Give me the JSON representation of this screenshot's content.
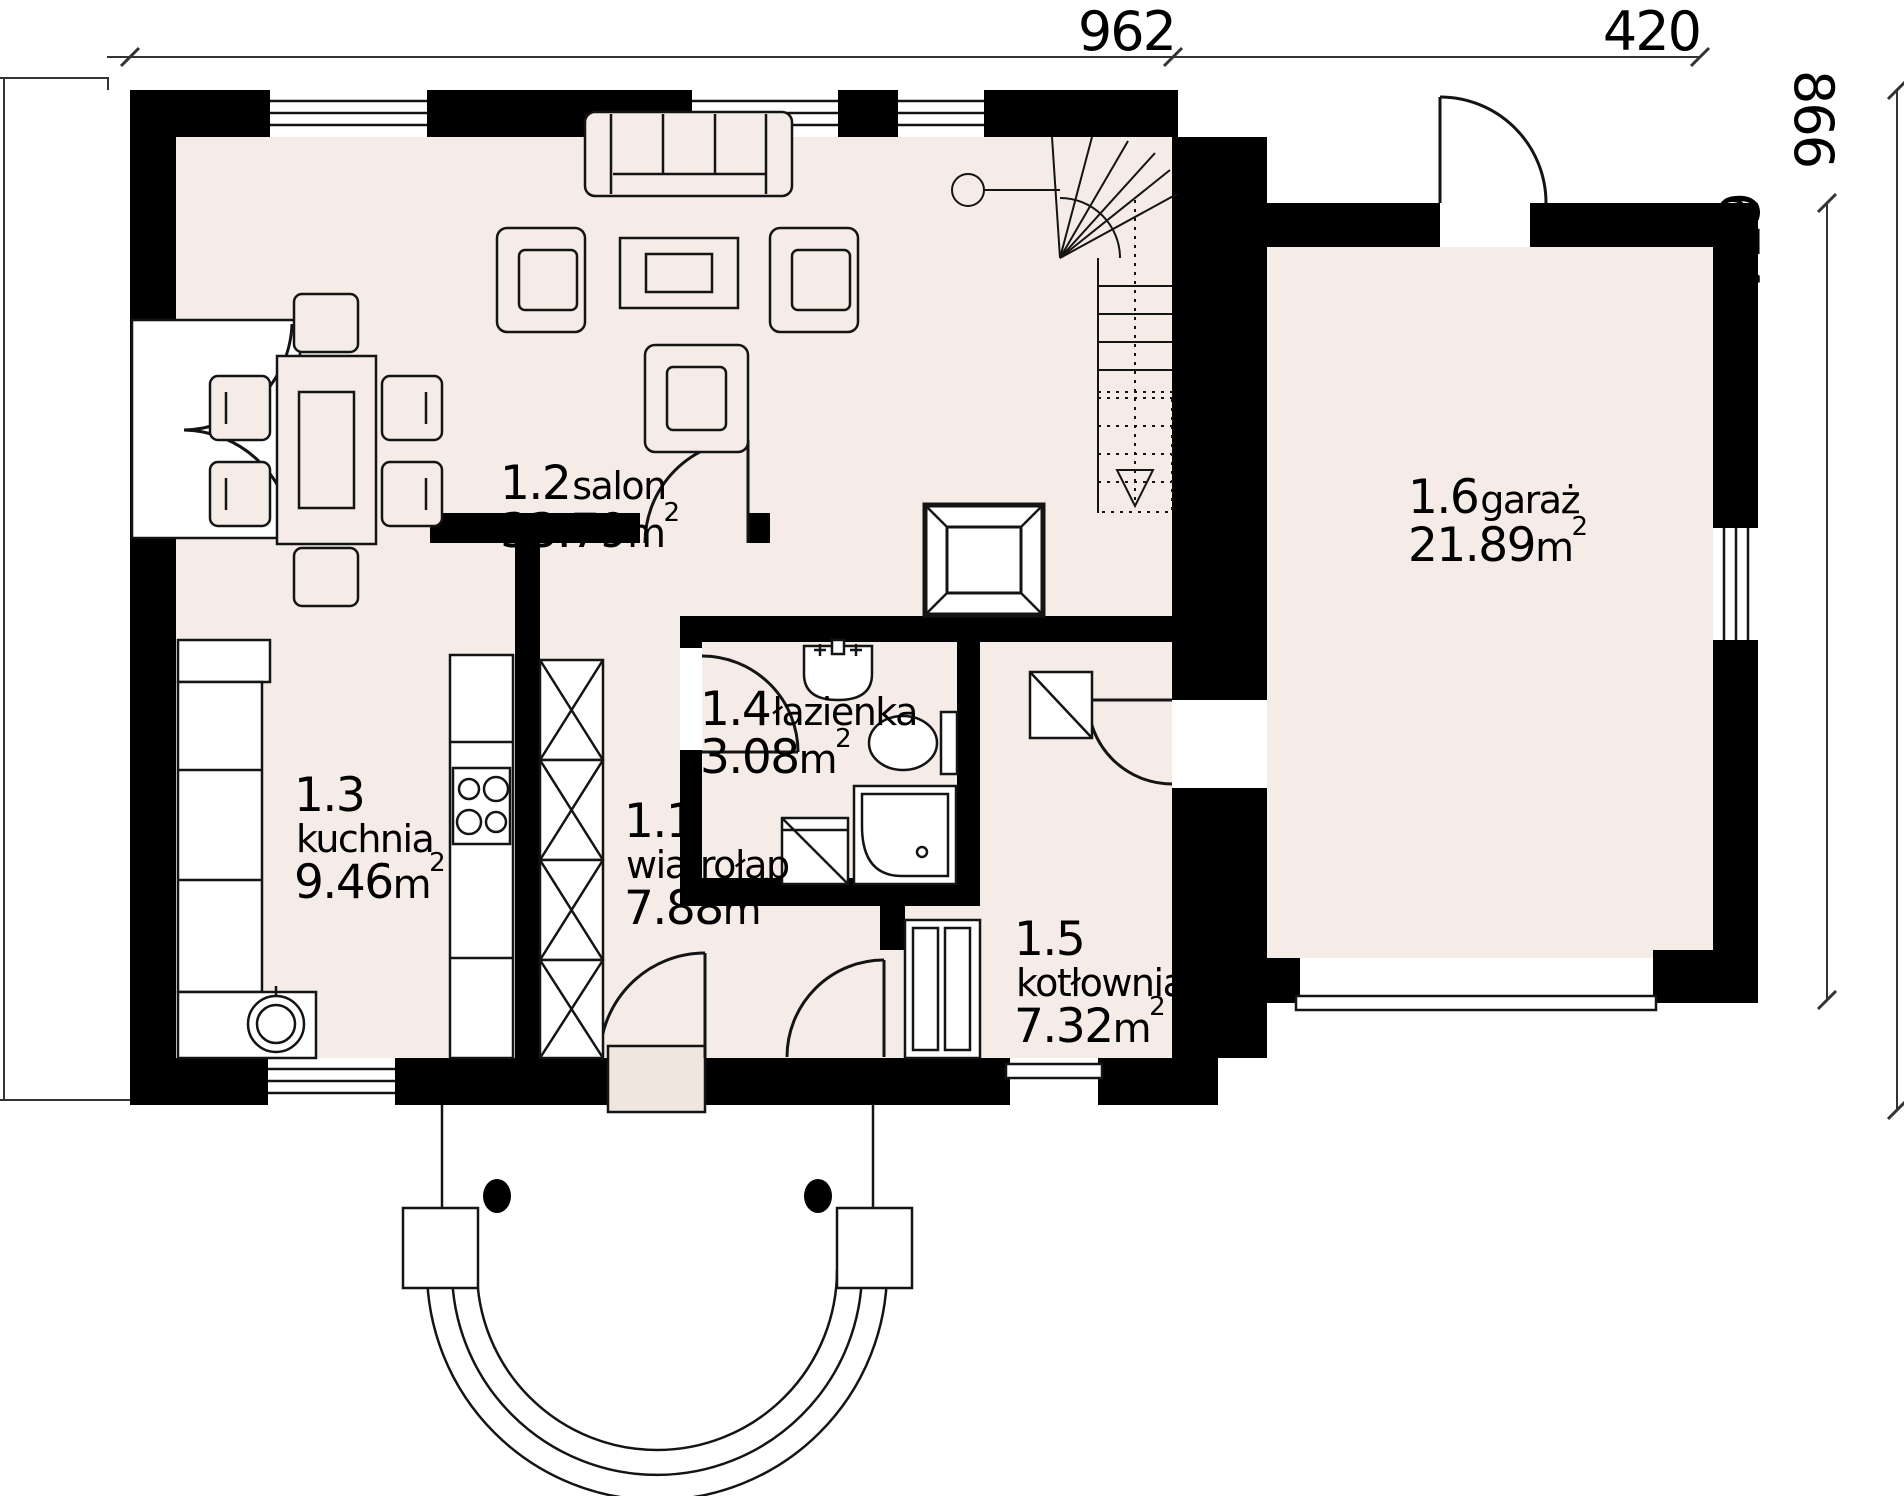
{
  "plan": {
    "unit": "m",
    "unit_exponent": "2",
    "rooms": [
      {
        "number": "1.1",
        "name": "wiatrołap",
        "area": "7.88"
      },
      {
        "number": "1.2",
        "name": "salon",
        "area": "33.79"
      },
      {
        "number": "1.3",
        "name": "kuchnia",
        "area": "9.46"
      },
      {
        "number": "1.4",
        "name": "łazienka",
        "area": "3.08"
      },
      {
        "number": "1.5",
        "name": "kotłownia",
        "area": "7.32"
      },
      {
        "number": "1.6",
        "name": "garaż",
        "area": "21.89"
      }
    ],
    "dimensions": {
      "top_main": "962",
      "top_garage": "420",
      "right_total": "866",
      "right_garage": "674"
    },
    "colors": {
      "wall": "#000000",
      "floor": "#f5ece7",
      "line": "#141414",
      "background": "#ffffff"
    }
  }
}
